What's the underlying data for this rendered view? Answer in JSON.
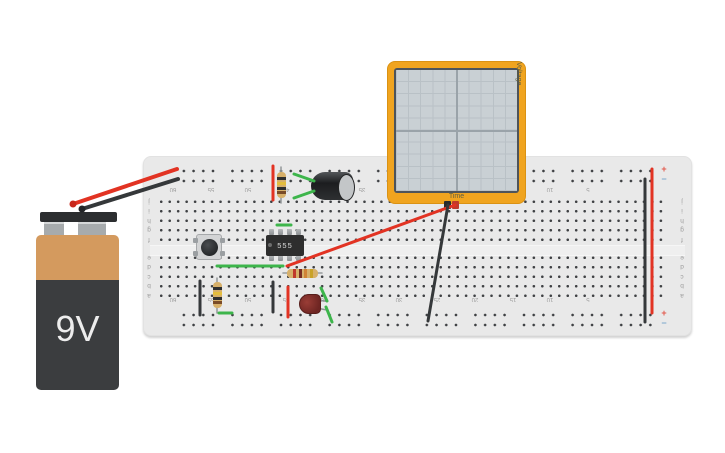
{
  "app": {
    "background": "#ffffff"
  },
  "battery": {
    "label": "9V",
    "body_color": "#3b3d3f",
    "band_color": "#d49a5e"
  },
  "breadboard": {
    "body_color": "#e9e9e9",
    "col_labels": [
      "60",
      "55",
      "50",
      "45",
      "40",
      "35",
      "30",
      "25",
      "20",
      "15",
      "10",
      "5"
    ],
    "row_letters_top": [
      "j",
      "i",
      "h",
      "g",
      "f"
    ],
    "row_letters_bottom": [
      "e",
      "d",
      "c",
      "b",
      "a"
    ],
    "plus": "+",
    "minus": "−"
  },
  "oscilloscope": {
    "time_label": "Time",
    "voltage_label": "Voltage",
    "frame_color": "#f0a41f",
    "screen_color": "#c9d0d4"
  },
  "ic": {
    "label": "555"
  },
  "resistors": {
    "r_top_vertical": {
      "bands": [
        "#2f2f2f",
        "#e3bd3d",
        "#2f2f2f",
        "#7a4c28"
      ]
    },
    "r_bottom_vertical": {
      "bands": [
        "#2f2f2f",
        "#e3bd3d",
        "#2f2f2f",
        "#7a4c28"
      ]
    },
    "r_horizontal": {
      "bands": [
        "#c0392b",
        "#7a2d22",
        "#d08336",
        "#c9a227"
      ]
    }
  },
  "leads": [
    {
      "name": "resistor-top-lead",
      "x1": 281,
      "y1": 167,
      "x2": 281,
      "y2": 203,
      "color": "#989c9e",
      "width": 1.6
    },
    {
      "name": "resistor-bottom-lead",
      "x1": 217,
      "y1": 278,
      "x2": 217,
      "y2": 313,
      "color": "#989c9e",
      "width": 1.6
    },
    {
      "name": "resistor-horizontal-lead",
      "x1": 283,
      "y1": 273,
      "x2": 322,
      "y2": 273,
      "color": "#989c9e",
      "width": 1.6
    },
    {
      "name": "led-lead-top",
      "x1": 316,
      "y1": 300,
      "x2": 325,
      "y2": 301,
      "color": "#8d9193",
      "width": 1.4
    },
    {
      "name": "led-lead-bottom",
      "x1": 316,
      "y1": 308,
      "x2": 327,
      "y2": 310,
      "color": "#8d9193",
      "width": 1.4
    }
  ],
  "wires": [
    {
      "name": "battery-positive-wire",
      "x1": 73,
      "y1": 204,
      "x2": 177,
      "y2": 169,
      "color": "#e23323",
      "width": 4
    },
    {
      "name": "battery-negative-wire",
      "x1": 82,
      "y1": 209,
      "x2": 178,
      "y2": 179,
      "color": "#35383a",
      "width": 4
    },
    {
      "name": "red-jumper-top-rail",
      "x1": 273,
      "y1": 166,
      "x2": 273,
      "y2": 200,
      "color": "#e23323",
      "width": 3
    },
    {
      "name": "red-jumper-bottom",
      "x1": 288,
      "y1": 287,
      "x2": 288,
      "y2": 317,
      "color": "#e23323",
      "width": 3
    },
    {
      "name": "red-jumper-right-rails",
      "x1": 652,
      "y1": 169,
      "x2": 652,
      "y2": 313,
      "color": "#e23323",
      "width": 3
    },
    {
      "name": "scope-probe-red-wire",
      "x1": 455,
      "y1": 205,
      "x2": 287,
      "y2": 266,
      "color": "#e23323",
      "width": 3
    },
    {
      "name": "scope-probe-black-wire",
      "x1": 448,
      "y1": 205,
      "x2": 428,
      "y2": 321,
      "color": "#35383a",
      "width": 3
    },
    {
      "name": "black-jumper-left",
      "x1": 200,
      "y1": 281,
      "x2": 200,
      "y2": 315,
      "color": "#35383a",
      "width": 3
    },
    {
      "name": "black-jumper-middle",
      "x1": 273,
      "y1": 282,
      "x2": 273,
      "y2": 312,
      "color": "#35383a",
      "width": 3
    },
    {
      "name": "black-jumper-right-rails",
      "x1": 645,
      "y1": 179,
      "x2": 645,
      "y2": 322,
      "color": "#35383a",
      "width": 3
    },
    {
      "name": "green-jumper-button-to-ic",
      "x1": 217,
      "y1": 266,
      "x2": 283,
      "y2": 266,
      "color": "#3db54b",
      "width": 3
    },
    {
      "name": "green-jumper-above-ic",
      "x1": 277,
      "y1": 225,
      "x2": 291,
      "y2": 225,
      "color": "#3db54b",
      "width": 3
    },
    {
      "name": "green-jumper-cap-upper",
      "x1": 294,
      "y1": 174,
      "x2": 314,
      "y2": 181,
      "color": "#3db54b",
      "width": 3
    },
    {
      "name": "green-jumper-cap-lower",
      "x1": 294,
      "y1": 198,
      "x2": 314,
      "y2": 191,
      "color": "#3db54b",
      "width": 3
    },
    {
      "name": "green-jumper-bottom-rail",
      "x1": 219,
      "y1": 313,
      "x2": 232,
      "y2": 313,
      "color": "#3db54b",
      "width": 3
    },
    {
      "name": "green-jumper-led-upper",
      "x1": 321,
      "y1": 288,
      "x2": 327,
      "y2": 301,
      "color": "#3db54b",
      "width": 3
    },
    {
      "name": "green-jumper-led-lower",
      "x1": 326,
      "y1": 307,
      "x2": 332,
      "y2": 322,
      "color": "#3db54b",
      "width": 3
    }
  ],
  "wire_dots": [
    {
      "name": "battery-positive-terminal",
      "x": 73,
      "y": 204,
      "r": 3.5,
      "color": "#c8281c"
    },
    {
      "name": "battery-negative-terminal",
      "x": 82,
      "y": 209,
      "r": 3.5,
      "color": "#232527"
    }
  ]
}
